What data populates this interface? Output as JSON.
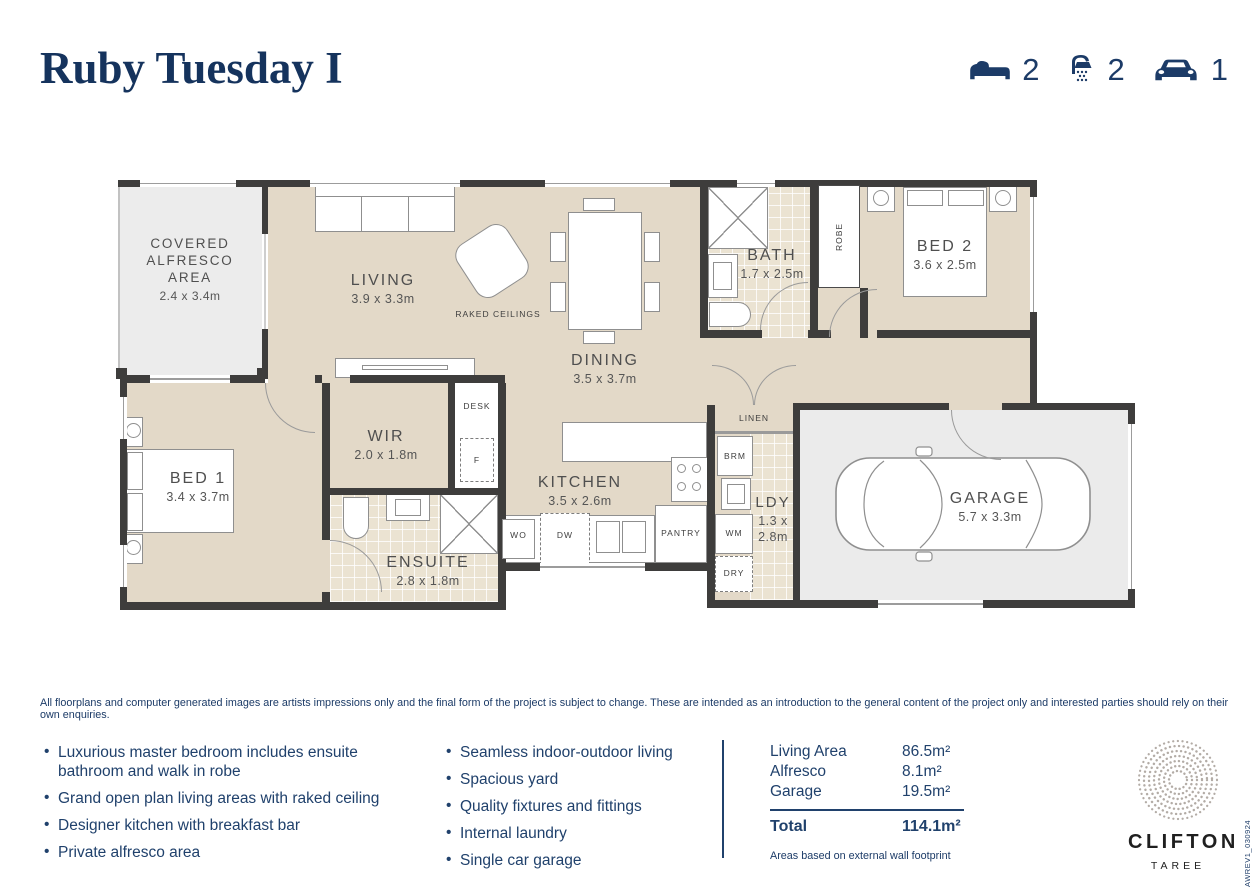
{
  "meta": {
    "title": "Ruby Tuesday I",
    "doc_code": "AWREV1_030924"
  },
  "stats": [
    {
      "name": "bedrooms",
      "icon": "bed-icon",
      "value": "2"
    },
    {
      "name": "bathrooms",
      "icon": "shower-icon",
      "value": "2"
    },
    {
      "name": "cars",
      "icon": "car-icon",
      "value": "1"
    }
  ],
  "floorplan": {
    "rooms": [
      {
        "name": "COVERED ALFRESCO AREA",
        "dims": "2.4 x 3.4m"
      },
      {
        "name": "LIVING",
        "dims": "3.9 x 3.3m"
      },
      {
        "name": "DINING",
        "dims": "3.5 x 3.7m"
      },
      {
        "name": "BATH",
        "dims": "1.7 x 2.5m"
      },
      {
        "name": "BED 2",
        "dims": "3.6 x 2.5m"
      },
      {
        "name": "BED 1",
        "dims": "3.4 x 3.7m"
      },
      {
        "name": "WIR",
        "dims": "2.0 x 1.8m"
      },
      {
        "name": "ENSUITE",
        "dims": "2.8 x 1.8m"
      },
      {
        "name": "KITCHEN",
        "dims": "3.5 x 2.6m"
      },
      {
        "name": "LDY",
        "dims": "1.3 x 2.8m"
      },
      {
        "name": "GARAGE",
        "dims": "5.7 x 3.3m"
      }
    ],
    "notes": {
      "raked_ceilings": "RAKED CEILINGS"
    },
    "fixtures": {
      "robe": "ROBE",
      "desk": "DESK",
      "fridge": "F",
      "wall_oven": "WO",
      "dishwasher": "DW",
      "pantry": "PANTRY",
      "broom": "BRM",
      "washer": "WM",
      "dryer": "DRY",
      "linen": "LINEN"
    }
  },
  "disclaimer": "All floorplans and computer generated images are artists impressions only and the final form of the project is subject to change. These are intended as an introduction to the general content of the project only and interested parties should rely on their own enquiries.",
  "features": {
    "col1": [
      "Luxurious master bedroom includes ensuite bathroom and walk in robe",
      "Grand open plan living areas with raked ceiling",
      "Designer kitchen with breakfast bar",
      "Private alfresco area"
    ],
    "col2": [
      "Seamless indoor-outdoor living",
      "Spacious yard",
      "Quality fixtures and fittings",
      "Internal laundry",
      "Single car garage"
    ]
  },
  "areas": {
    "rows": [
      {
        "label": "Living Area",
        "value": "86.5m²"
      },
      {
        "label": "Alfresco",
        "value": "8.1m²"
      },
      {
        "label": "Garage",
        "value": "19.5m²"
      }
    ],
    "total_label": "Total",
    "total_value": "114.1m²",
    "note": "Areas based on external wall footprint"
  },
  "logo": {
    "brand": "CLIFTON",
    "location": "TAREE"
  }
}
